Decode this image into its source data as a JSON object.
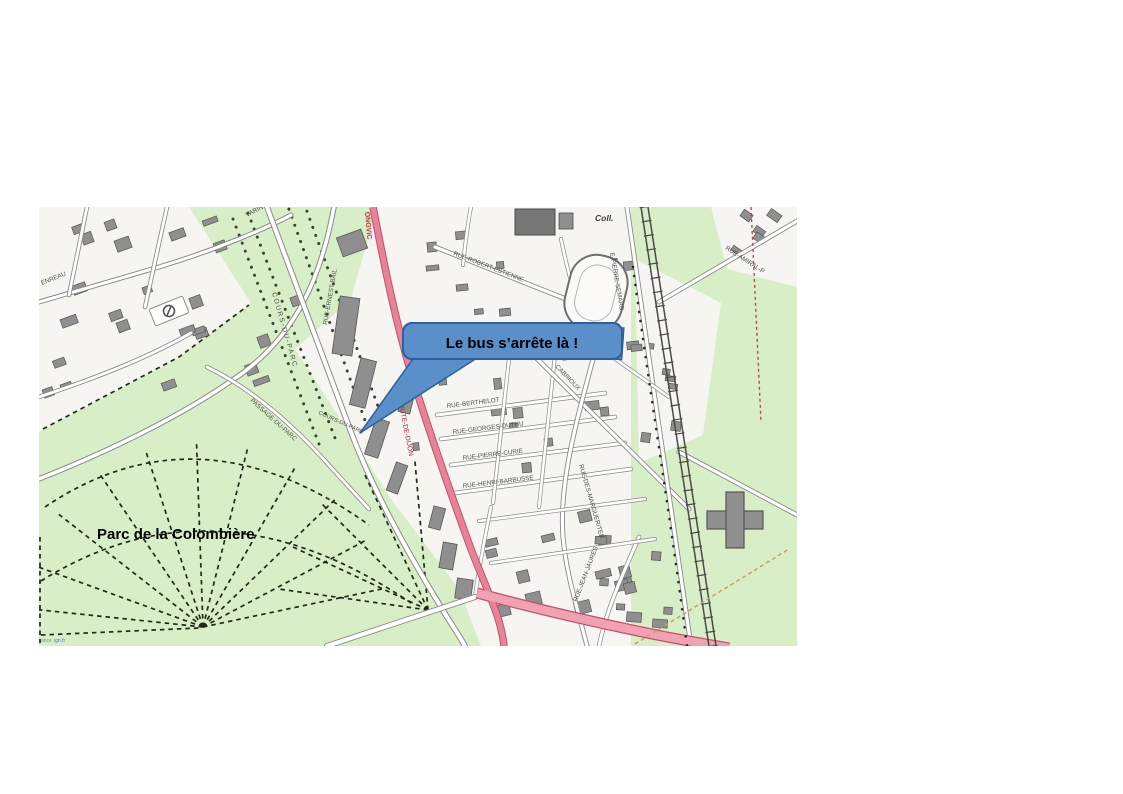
{
  "page": {
    "background": "#ffffff"
  },
  "callout": {
    "text": "Le bus s’arrête là !",
    "fill": "#5a8fc9",
    "border": "#2e5f9d",
    "text_color": "#000000"
  },
  "map": {
    "park_label": "Parc de la Colombière",
    "attribution": {
      "prefix": "ance",
      "link": "ign.fr"
    },
    "colors": {
      "map_background": "#f6f5f1",
      "park_green": "#d8eec6",
      "building_gray": "#8f8f8f",
      "building_outline": "#565656",
      "road_fill": "#ffffff",
      "road_casing": "#8a8a8a",
      "main_road_fill": "#e88298",
      "main_road_casing": "#c2506c",
      "boulevard_fill": "#f0a2b2",
      "railway": "#4a4a4a",
      "path_dashed": "#1f2a1a",
      "tree_dots": "#39462f",
      "street_label": "#4f4f4f",
      "road_label_red": "#9b2a3e",
      "town_label_red": "#c2303c",
      "pool_blue": "#4f7cc7",
      "attribution_gray": "#8a8a8a",
      "attribution_blue": "#3d7fd2"
    },
    "labels": [
      {
        "name": "park-label",
        "text": "Parc de la Colombière",
        "x": 58,
        "y": 332,
        "rot": 0,
        "size": 15,
        "color": "#000000",
        "weight": "bold"
      },
      {
        "name": "street-label-rue-robert-estienne",
        "text": "RUE-ROBERT-ESTIENNE",
        "x": 414,
        "y": 48,
        "rot": 21,
        "size": 6.3
      },
      {
        "name": "street-label-rue-berthelot",
        "text": "RUE-BERTHELOT",
        "x": 408,
        "y": 201,
        "rot": -7,
        "size": 6.3
      },
      {
        "name": "street-label-rue-georges-duthu",
        "text": "RUE-GEORGES-DUTHU",
        "x": 414,
        "y": 227,
        "rot": -7,
        "size": 6.3
      },
      {
        "name": "street-label-rue-pierre-curie",
        "text": "RUE-PIERRE-CURIE",
        "x": 424,
        "y": 253,
        "rot": -7,
        "size": 6.3
      },
      {
        "name": "street-label-rue-henri-barbusse",
        "text": "RUE-HENRI-BARBUSSE",
        "x": 424,
        "y": 281,
        "rot": -7,
        "size": 6.3
      },
      {
        "name": "street-label-rue-des-marguerites",
        "text": "RUE-DES-MARGUERITES",
        "x": 540,
        "y": 258,
        "rot": 74,
        "size": 6.3
      },
      {
        "name": "street-label-rue-jean-jaures",
        "text": "RUE-JEAN-JAURES",
        "x": 538,
        "y": 395,
        "rot": -69,
        "size": 6.3
      },
      {
        "name": "street-label-cabrioux",
        "text": "CABRIOUX",
        "x": 516,
        "y": 160,
        "rot": 46,
        "size": 6.3
      },
      {
        "name": "street-label-cours-du-parc",
        "text": "COURS-DU-PARC",
        "x": 233,
        "y": 86,
        "rot": 74,
        "size": 6.8,
        "spacing": 1.6
      },
      {
        "name": "street-label-cours-du-parc-2",
        "text": "COURS-DU-PARC",
        "x": 279,
        "y": 207,
        "rot": 24,
        "size": 5.8
      },
      {
        "name": "street-label-passage-du-parc",
        "text": "PASSAGE-DU-PARC",
        "x": 211,
        "y": 194,
        "rot": 42,
        "size": 6.3
      },
      {
        "name": "street-label-rue-ernest-bail",
        "text": "RUE-ERNEST-BAIL",
        "x": 288,
        "y": 118,
        "rot": -80,
        "size": 6.3
      },
      {
        "name": "street-label-varin",
        "text": "VARIN",
        "x": 208,
        "y": 10,
        "rot": -28,
        "size": 6.3
      },
      {
        "name": "street-label-enreau",
        "text": "ENREAU",
        "x": 3,
        "y": 78,
        "rot": -22,
        "size": 6.3
      },
      {
        "name": "street-label-rue-pierre-semard",
        "text": "E-PIERRE-SEMARD",
        "x": 571,
        "y": 46,
        "rot": 80,
        "size": 6.3
      },
      {
        "name": "street-label-rue-amiral",
        "text": "RUE-AMIRAL-P",
        "x": 686,
        "y": 42,
        "rot": 33,
        "size": 6.3
      },
      {
        "name": "road-label-route-de-dijon",
        "text": "OUTE-DE-DIJON",
        "x": 360,
        "y": 197,
        "rot": 79,
        "size": 6.8,
        "color": "#9b2a3e"
      },
      {
        "name": "road-label-longvic",
        "text": "ONGVIC",
        "x": 326,
        "y": 5,
        "rot": 85,
        "size": 7,
        "color": "#c2303c",
        "weight": "bold"
      },
      {
        "name": "poi-label-college",
        "text": "Coll.",
        "x": 556,
        "y": 14,
        "rot": 0,
        "size": 8.5,
        "color": "#3a3a3a",
        "weight": "bold",
        "style": "italic"
      },
      {
        "name": "attribution-text",
        "text": "ance",
        "x": 2,
        "y": 435,
        "rot": 0,
        "size": 5,
        "color": "#8a8a8a"
      },
      {
        "name": "attribution-link",
        "text": "ign.fr",
        "x": 15,
        "y": 435,
        "rot": 0,
        "size": 5,
        "color": "#3d7fd2",
        "interactable": true
      }
    ]
  }
}
